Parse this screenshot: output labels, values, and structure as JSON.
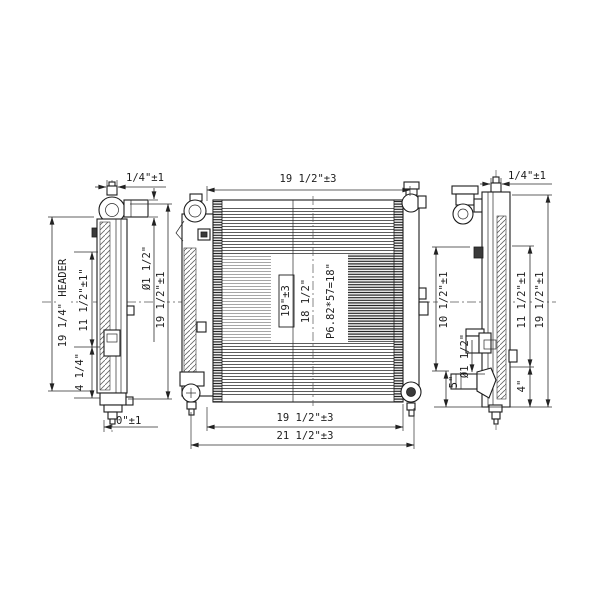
{
  "page": {
    "background": "#ffffff",
    "line_color": "#2a2a2a",
    "description": "Radiator technical drawing, three orthographic views with dimensions"
  },
  "views": {
    "left_side_view": {
      "dims": {
        "top_offset": "1/4\"±1",
        "pipe_diameter": "Ø1 1/2\"",
        "overall_height": "19 1/2\"±1",
        "header_height": "19 1/4\" HEADER",
        "upper_mount": "11 1/2\"±1\"",
        "lower_mount": "4 1/4\"",
        "drain_offset": "0\"±1"
      }
    },
    "front_view": {
      "dims": {
        "core_width_top": "19 1/2\"±3",
        "core_height_boxed": "19\"±3",
        "tube_length": "18 1/2\"",
        "fin_pitch": "P6.82*57=18\"",
        "core_width_bottom": "19 1/2\"±3",
        "overall_width": "21 1/2\"±3"
      }
    },
    "right_side_view": {
      "dims": {
        "top_offset": "1/4\"±1",
        "upper_left": "10 1/2\"±1",
        "lower_left": "5\"",
        "pipe_diameter": "Ø1 1/2\"",
        "upper_right": "11 1/2\"±1",
        "lower_right": "4\"",
        "overall_height": "19 1/2\"±1"
      }
    }
  }
}
